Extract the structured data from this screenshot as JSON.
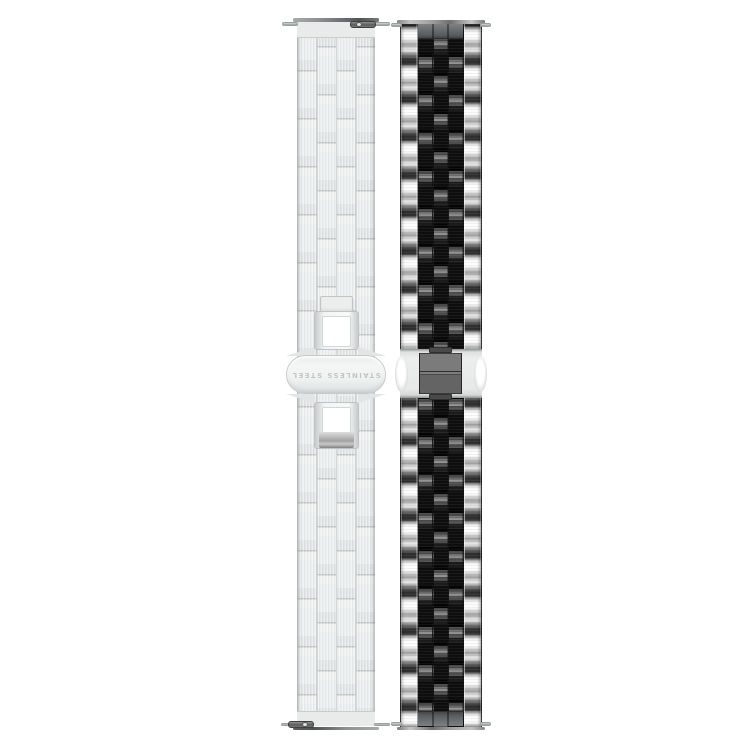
{
  "product_photo": {
    "background_color": "#ffffff",
    "left_band": {
      "label": "silver-brick-link-watch-band",
      "clasp_engraving": "STAINLESS STEEL",
      "base_color": "#eaecec",
      "seam_color": "#c0c4c4",
      "hardware_color": "#6d7272"
    },
    "right_band": {
      "label": "silver-black-jubilee-watch-band",
      "outer_link_color": "#fbfbfb",
      "center_link_color": "#0e0e0e",
      "end_link_color": "#575b5b",
      "clasp_plate_color": "#646464"
    }
  }
}
